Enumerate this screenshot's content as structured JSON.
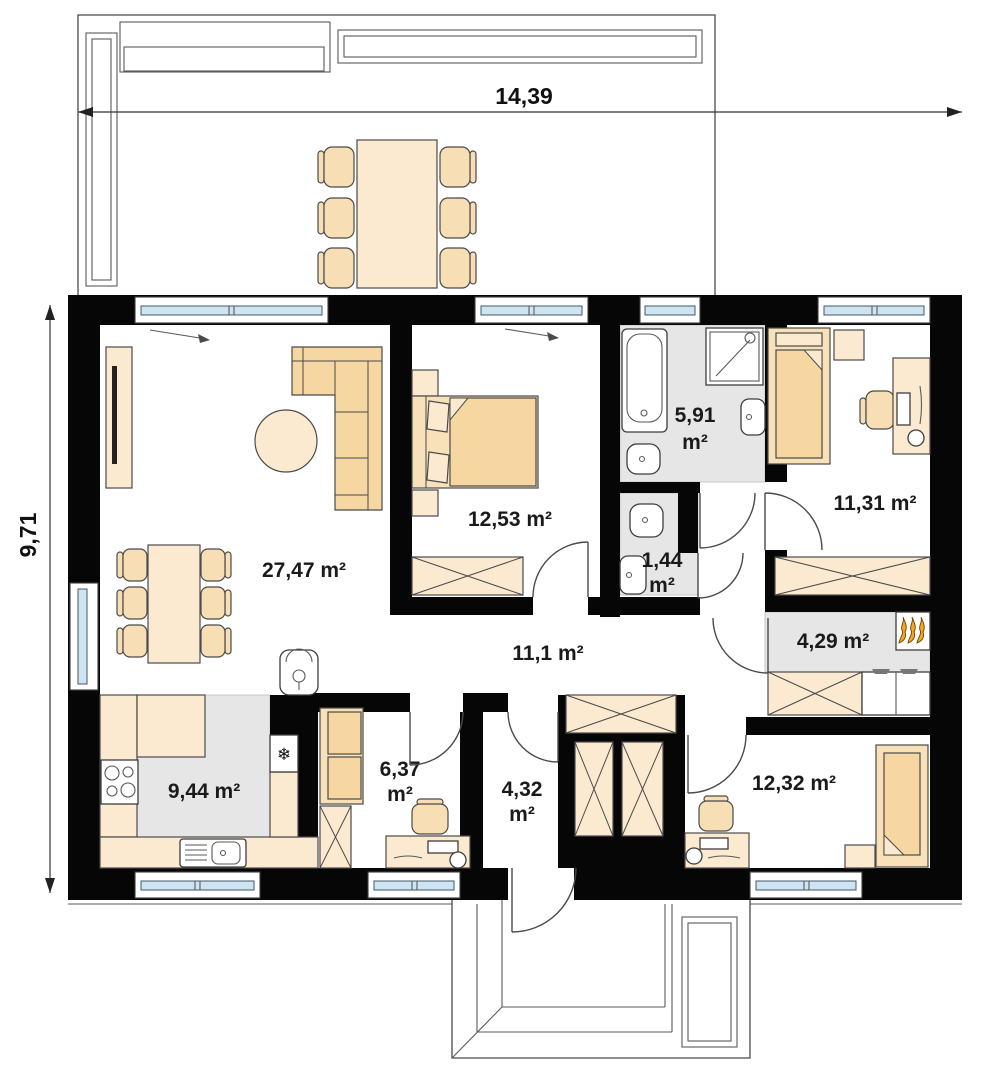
{
  "palette": {
    "wall": "#060606",
    "furniture_light": "#FBEAD0",
    "furniture_tan": "#F6D7A1",
    "bed_light": "#F8E0B8",
    "floor_grey": "#E6E6E6",
    "window_glass": "#CFE4F1",
    "flame_orange": "#F5A623"
  },
  "dimensions": {
    "width": "14,39",
    "height": "9,71"
  },
  "rooms": {
    "living": {
      "label": "27,47 m²"
    },
    "bedroom_left": {
      "label": "12,53 m²"
    },
    "bathroom": {
      "value": "5,91",
      "unit": "m²"
    },
    "wc": {
      "value": "1,44",
      "unit": "m²"
    },
    "bedroom_right": {
      "label": "11,31 m²"
    },
    "hall": {
      "label": "11,1 m²"
    },
    "utility": {
      "label": "4,29 m²"
    },
    "kitchen": {
      "label": "9,44 m²"
    },
    "office": {
      "value": "6,37",
      "unit": "m²"
    },
    "entry": {
      "value": "4,32",
      "unit": "m²"
    },
    "bedroom_bottom": {
      "label": "12,32 m²"
    }
  },
  "icons": {
    "fridge_snowflake": "❄"
  }
}
